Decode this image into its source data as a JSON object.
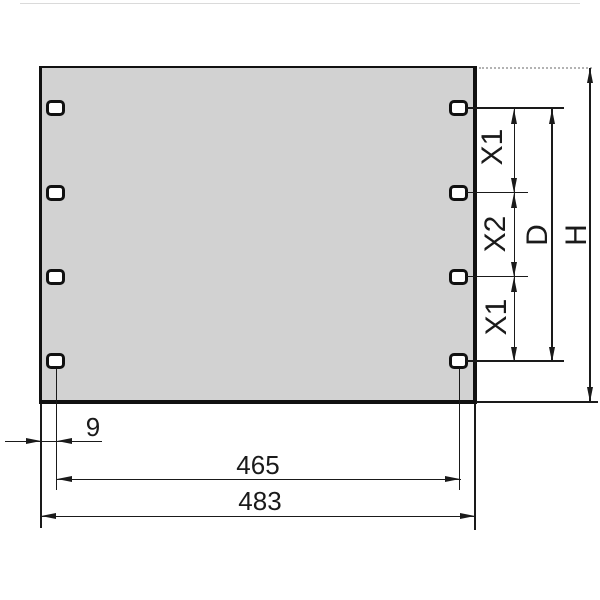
{
  "drawing": {
    "type": "technical-dimension-drawing",
    "colors": {
      "panel_fill": "#d2d2d2",
      "line": "#1a1a1a",
      "hole_fill": "#ffffff"
    },
    "dimension_labels": {
      "x1_top": "X1",
      "x2_mid": "X2",
      "x1_bottom": "X1",
      "hole_field_d": "D",
      "panel_height_h": "H",
      "edge_offset": "9",
      "hole_span": "465",
      "panel_width": "483"
    },
    "holes": {
      "count": 8,
      "columns": 2,
      "rows": 4
    }
  }
}
